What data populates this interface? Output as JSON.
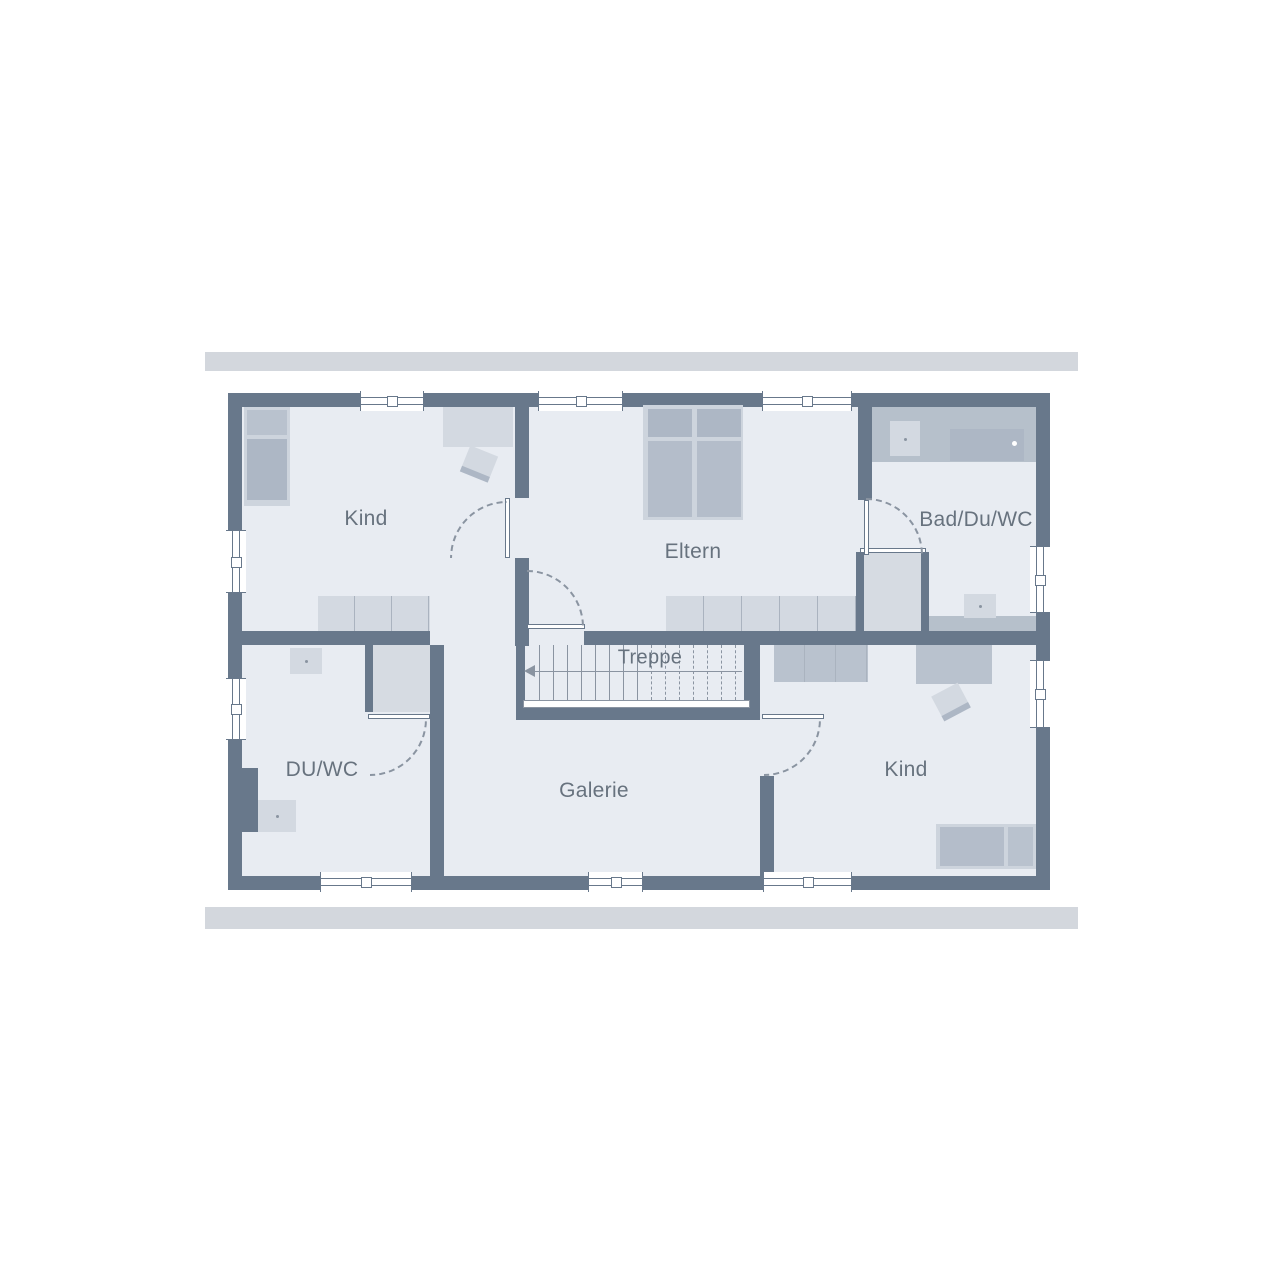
{
  "plan": {
    "type": "floorplan-upper-storey",
    "language": "de"
  },
  "rooms": {
    "kind_top_left": {
      "label": "Kind"
    },
    "eltern": {
      "label": "Eltern"
    },
    "bad": {
      "label": "Bad/Du/WC"
    },
    "treppe": {
      "label": "Treppe"
    },
    "duwc": {
      "label": "DU/WC"
    },
    "galerie": {
      "label": "Galerie"
    },
    "kind_bottom_right": {
      "label": "Kind"
    }
  },
  "stairs": {
    "tread_count": 15,
    "solid_treads": 8,
    "spacing_px": 14
  },
  "colors": {
    "wall": "#68788b",
    "floor": "#e8ecf2",
    "furn-light": "#d3d9e1",
    "furn-frame": "#cdd4dd",
    "furn-mid": "#b9c2ce",
    "matt": "#adb7c5",
    "matt2": "#b4bdca",
    "counter": "#b6c0cb",
    "shower": "#d6dbe2",
    "line": "#8a94a1",
    "sep": "#aab3bf",
    "label": "#67727e",
    "band": "#d3d7dd"
  }
}
